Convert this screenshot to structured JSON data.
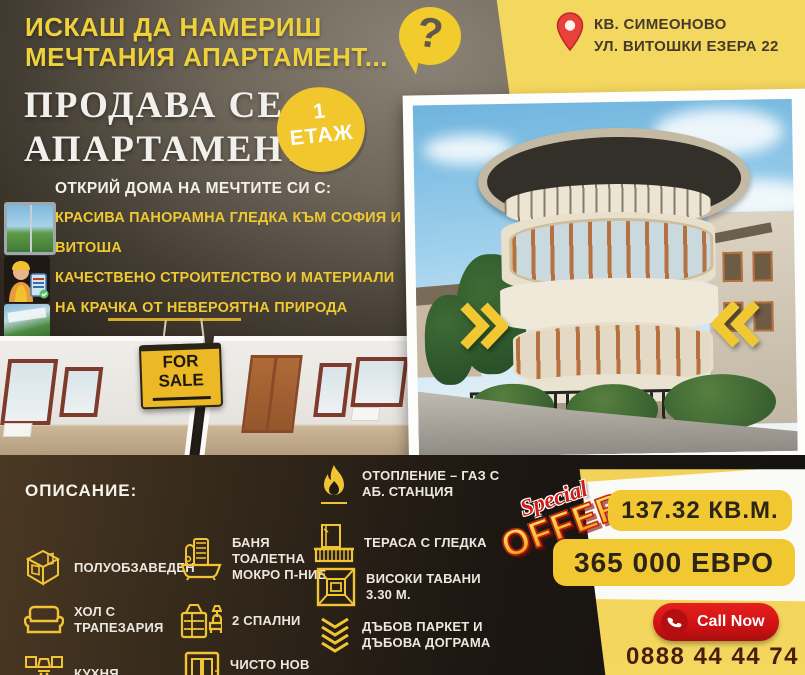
{
  "colors": {
    "accent_yellow": "#F2C832",
    "panel_yellow": "#F4D75F",
    "red": "#D31B14",
    "dark_bg": "#241E17",
    "maroon_phone": "#4A1C0C"
  },
  "header": {
    "headline_line1": "ИСКАШ ДА НАМЕРИШ",
    "headline_line2": "МЕЧТАНИЯ АПАРТАМЕНТ...",
    "question_mark": "?"
  },
  "location": {
    "line1": "КВ. СИМЕОНОВО",
    "line2": "УЛ. ВИТОШКИ ЕЗЕРА 22"
  },
  "title": {
    "line1": "ПРОДАВА СЕ",
    "line2": "АПАРТАМЕНТ"
  },
  "floor_badge": {
    "line1": "1",
    "line2": "ЕТАЖ"
  },
  "features": {
    "heading": "ОТКРИЙ ДОМА НА МЕЧТИТЕ СИ С:",
    "items": [
      {
        "label": "КРАСИВА ПАНОРАМНА ГЛЕДКА КЪМ СОФИЯ И ВИТОША"
      },
      {
        "label": "КАЧЕСТВЕНО СТРОИТЕЛСТВО И МАТЕРИАЛИ"
      },
      {
        "label": "НА КРАЧКА ОТ НЕВЕРОЯТНА ПРИРОДА"
      }
    ]
  },
  "sale_sign": {
    "line1": "FOR",
    "line2": "SALE"
  },
  "description": {
    "heading": "ОПИСАНИЕ:",
    "col1": [
      {
        "icon": "floorplan-icon",
        "label": "ПОЛУОБЗАВЕДЕН"
      },
      {
        "icon": "sofa-icon",
        "label": "ХОЛ С ТРАПЕЗАРИЯ"
      },
      {
        "icon": "kitchen-icon",
        "label": "КУХНЯ"
      }
    ],
    "col2": [
      {
        "icon": "bathroom-icon",
        "label": "БАНЯ ТОАЛЕТНА МОКРО П-НИЕ"
      },
      {
        "icon": "bedroom-icon",
        "label": "2 СПАЛНИ"
      },
      {
        "icon": "elevator-icon",
        "label": "ЧИСТО НОВ АСАНСЬОР"
      }
    ],
    "col3": [
      {
        "icon": "flame-icon",
        "label": "ОТОПЛЕНИЕ – ГАЗ С АБ. СТАНЦИЯ"
      },
      {
        "icon": "balcony-icon",
        "label": "ТЕРАСА С ГЛЕДКА"
      },
      {
        "icon": "ceiling-icon",
        "label": "ВИСОКИ ТАВАНИ 3.30 М."
      },
      {
        "icon": "parquet-icon",
        "label": "ДЪБОВ ПАРКЕТ И ДЪБОВА ДОГРАМА"
      }
    ]
  },
  "offer": {
    "special_line1": "Special",
    "special_line2": "OFFER",
    "area": "137.32 КВ.М.",
    "price": "365 000 ЕВРО",
    "call_button": "Call Now",
    "phone": "0888 44 44 74"
  }
}
